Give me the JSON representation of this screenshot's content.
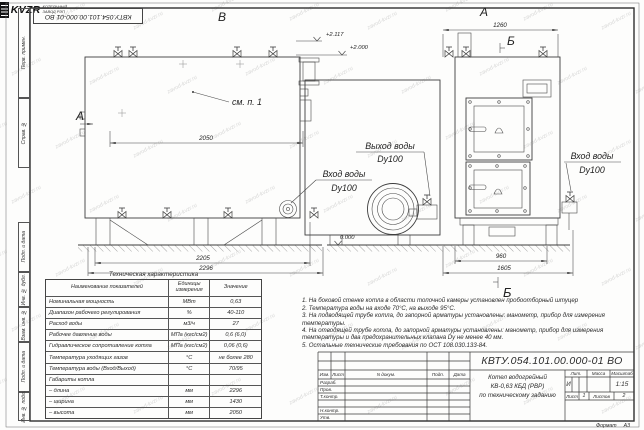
{
  "watermark": {
    "text": "zavod-kvzr.ru"
  },
  "frame": {
    "doc_number_top": "КВТУ.054.101.00.000-01 ВО",
    "stamp_fields": [
      "Перв. примен.",
      "Справ. №",
      "Подп. и дата",
      "Инв. № дубл.",
      "Взам. инв. №",
      "Подп. и дата",
      "Инв. № подл."
    ]
  },
  "drawing": {
    "views": {
      "left": "В",
      "right_top": "А",
      "side_marker": "А",
      "b_top": "Б",
      "b_bottom": "Б"
    },
    "elevations": {
      "top1": "+2.117",
      "top2": "+2.000",
      "ground": "0.000"
    },
    "dims": {
      "d2050": "2050",
      "d2205": "2205",
      "d2296": "2296",
      "d1260": "1260",
      "d960": "960",
      "d1605": "1605"
    },
    "labels": {
      "see_note": "см. п. 1",
      "outlet_line1": "Выход воды",
      "outlet_line2": "Dy100",
      "inlet_mid_line1": "Вход воды",
      "inlet_mid_line2": "Dy100",
      "inlet_right_line1": "Вход воды",
      "inlet_right_line2": "Dy100"
    }
  },
  "tech_table": {
    "title": "Техническая характеристика",
    "headers": {
      "name": "Наименование показателей",
      "units": "Единицы измерения",
      "value": "Значение"
    },
    "rows": [
      {
        "name": "Номинальная мощность",
        "units": "МВт",
        "value": "0,63"
      },
      {
        "name": "Диапазон рабочего регулирования",
        "units": "%",
        "value": "40-110"
      },
      {
        "name": "Расход воды",
        "units": "м3/ч",
        "value": "27"
      },
      {
        "name": "Рабочее давление воды",
        "units": "МПа (кгс/см2)",
        "value": "0,6 (6,0)"
      },
      {
        "name": "Гидравлическое сопротивление котла",
        "units": "МПа (кгс/см2)",
        "value": "0,06 (0,6)"
      },
      {
        "name": "Температура уходящих газов",
        "units": "°С",
        "value": "не более 280"
      },
      {
        "name": "Температура воды (Вход/Выход)",
        "units": "°С",
        "value": "70/95"
      },
      {
        "name": "Габариты котла",
        "units": "",
        "value": ""
      },
      {
        "name": "– длина",
        "units": "мм",
        "value": "2296"
      },
      {
        "name": "– ширина",
        "units": "мм",
        "value": "1430"
      },
      {
        "name": "– высота",
        "units": "мм",
        "value": "2050"
      }
    ]
  },
  "notes": [
    "1. На боковой стенке котла в области топочной камеры установлен пробоотборный штуцер",
    "2. Температура воды на входе 70°С, на выходе 95°С.",
    "3. На подводящей трубе котла, до запорной арматуры установлены: манометр, прибор для измерения температуры.",
    "4. На отводящей трубе котла, до запорной арматуры установлены: манометр, прибор для измерения температуры и два предохранительных клапана Dу не менее 40 мм.",
    "5. Остальные технические требования по ОСТ 108.030.133-84."
  ],
  "title_block": {
    "doc_number": "КВТУ.054.101.00.000-01  ВО",
    "columns": {
      "izm": "Изм.",
      "list": "Лист",
      "doc": "N докум.",
      "sign": "Подп.",
      "date": "Дата"
    },
    "rows": [
      "Разраб.",
      "Пров.",
      "Т.контр.",
      "",
      "Н.контр.",
      "Утв."
    ],
    "name_line1": "Котел водогрейный",
    "name_line2": "КВ-0,63 КБД (РВР)",
    "name_line3": "по техническому заданию",
    "lit_label": "Лит.",
    "lit_value": "И",
    "mass_label": "Масса",
    "mass_value": "",
    "scale_label": "Масштаб",
    "scale_value": "1:15",
    "sheet_label": "Лист",
    "sheet_value": "1",
    "sheets_label": "Листов",
    "sheets_value": "2",
    "company": "KVZR",
    "company_sub1": "КОТЕЛЬНЫЙ",
    "company_sub2": "ЗАВОД РЭП",
    "format_label": "Формат",
    "format_value": "А3"
  }
}
